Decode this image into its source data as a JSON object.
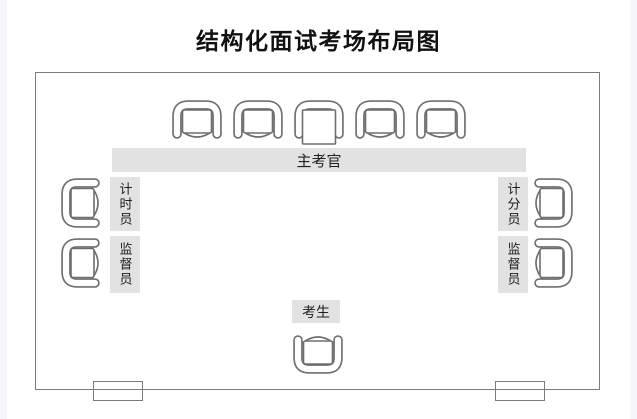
{
  "title": "结构化面试考场布局图",
  "room": {
    "examiner": {
      "label": "主考官",
      "seat_count": 5
    },
    "left": {
      "roles": [
        {
          "label": "计时员"
        },
        {
          "label": "监督员"
        }
      ],
      "seat_count": 2
    },
    "right": {
      "roles": [
        {
          "label": "计分员"
        },
        {
          "label": "监督员"
        }
      ],
      "seat_count": 2
    },
    "candidate": {
      "label": "考生",
      "seat_count": 1
    },
    "doors": {
      "count": 2
    }
  },
  "colors": {
    "label_bg": "#e2e2e2",
    "chair_stroke": "#6e6e6e",
    "wall": "#7c7c7c",
    "text": "#1f1f1f",
    "page_edge": "#f5f6fa"
  }
}
